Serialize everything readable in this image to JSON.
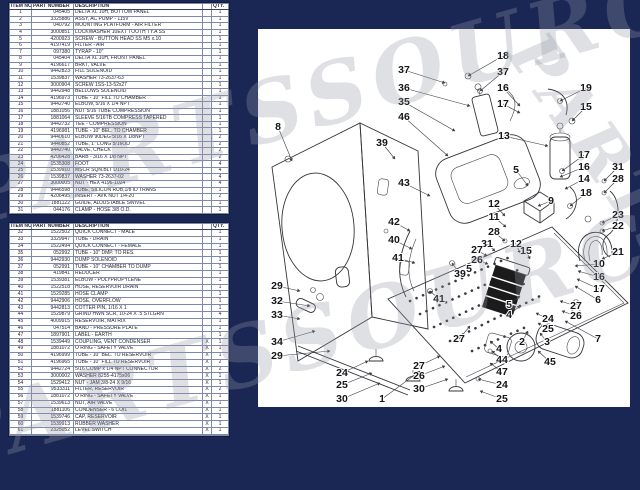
{
  "page": {
    "background_color": "#1a2755",
    "paper_color": "#ffffff"
  },
  "watermark": {
    "text": "PARTSSOURCE",
    "fragments": [
      {
        "text": "PARTSSOURCE",
        "x": -45,
        "y": 150,
        "rot": -16,
        "size": 84,
        "spacing": 8
      },
      {
        "text": "PARTSSOURCE",
        "x": -70,
        "y": 395,
        "rot": -16,
        "size": 84,
        "spacing": 8
      },
      {
        "text": "PARTSSO",
        "x": 556,
        "y": 18,
        "rot": 55,
        "size": 66,
        "spacing": 6
      }
    ]
  },
  "tables": {
    "headers": [
      "ITEM NO.",
      "PART NUMBER",
      "DESCRIPTION",
      "",
      "QTY."
    ],
    "table1": {
      "rows": [
        [
          "1",
          "045405",
          "DELTA XL 10H, BOTTOM PANEL",
          "",
          "1"
        ],
        [
          "2",
          "3325886",
          "ASSY, AC PUMP - 115V",
          "",
          "1"
        ],
        [
          "3",
          "040792",
          "MOUNTING PLATFORM - AIR FILTER",
          "",
          "1"
        ],
        [
          "4",
          "3000851",
          "LOCKWASHER 10EXT TOOTH TY.A SS",
          "",
          "1"
        ],
        [
          "5",
          "4200923",
          "SCREW - BUTTON HEAD SS M5 x.10",
          "",
          "1"
        ],
        [
          "6",
          "4197419",
          "FILTER - AIR",
          "",
          "1"
        ],
        [
          "7",
          "097380",
          "TYRAP - 10\"",
          "",
          "1"
        ],
        [
          "8",
          "045404",
          "DELTA XL 10H, FRONT PANEL",
          "",
          "1"
        ],
        [
          "9",
          "4196617",
          "BRKT, VALVE",
          "",
          "1"
        ],
        [
          "10",
          "9442823",
          "FILL SOLENOID",
          "",
          "1"
        ],
        [
          "11",
          "1539837",
          "WASHER 73-2637-63",
          "",
          "1"
        ],
        [
          "12",
          "3000904",
          "SCREW 1SS-13-52x27",
          "",
          "1"
        ],
        [
          "13",
          "9442948",
          "BELLOWS SOLENOID",
          "",
          "1"
        ],
        [
          "14",
          "4196973",
          "TUBE - 10\" FILL TO CHAMBER",
          "",
          "1"
        ],
        [
          "15",
          "9442740",
          "ELBOW, 5/16 X 1/4 NPT",
          "",
          "1"
        ],
        [
          "16",
          "1881056",
          "NUT 5/16 TUBE COMPRESSION",
          "",
          "1"
        ],
        [
          "17",
          "1881064",
          "SLEEVE 5/16TB COMPRESS TAPERED",
          "",
          "1"
        ],
        [
          "18",
          "9442732",
          "TEE - COMPRESSION",
          "",
          "1"
        ],
        [
          "19",
          "4196981",
          "TUBE - 10\" BEL. TO CHAMBER",
          "",
          "1"
        ],
        [
          "20",
          "9440610",
          "ELBOW 90DEG 5/16 X 1/8NPT",
          "",
          "2"
        ],
        [
          "21",
          "9440852",
          "TUBE, 1\" LONG 5/16OD",
          "",
          "2"
        ],
        [
          "22",
          "9442740",
          "VALVE, CHECK",
          "",
          "2"
        ],
        [
          "23",
          "4206428",
          "BARB - 3/16 X 1/8 NPT",
          "",
          "2"
        ],
        [
          "24",
          "1535308",
          "FOOT",
          "",
          "4"
        ],
        [
          "25",
          "1539910",
          "MSCR SQN.BLT D10-24",
          "",
          "4"
        ],
        [
          "26",
          "1539837",
          "WASHER 73-2637-02",
          "",
          "4"
        ],
        [
          "27",
          "3000005",
          "NUT - HEX 4196-1024",
          "",
          "4"
        ],
        [
          "28",
          "9446598",
          "TUBE, SILICON RUB,1/8 ID TRANS",
          "",
          "1"
        ],
        [
          "29",
          "4206495",
          "INSERT - AVK NUT 1/4-20",
          "",
          "2"
        ],
        [
          "30",
          "1881122",
          "GUIDE, ADJUSTABLE SWIVEL",
          "",
          "1"
        ],
        [
          "31",
          "044176",
          "CLAMP - HOSE 3/8 O.D.",
          "",
          "1"
        ]
      ]
    },
    "table2": {
      "rows": [
        [
          "32",
          "1522502",
          "QUICK CONNECT - MALE",
          "",
          "1"
        ],
        [
          "33",
          "3329947",
          "TUBE - DRAIN",
          "",
          "1"
        ],
        [
          "34",
          "1522494",
          "QUICK CONNECT - FEMALE",
          "",
          "1"
        ],
        [
          "35",
          "052992",
          "TUBE - 10\" DMP. TO RES.",
          "",
          "1"
        ],
        [
          "36",
          "9442930",
          "DUMP SOLENOID",
          "",
          "1"
        ],
        [
          "37",
          "052991",
          "TUBE - 10\" CHAMBER TO DUMP",
          "",
          "1"
        ],
        [
          "38",
          "419841",
          "REDUCER",
          "",
          "1"
        ],
        [
          "39",
          "1539381",
          "ELBOW - POLYPROPYLENE",
          "",
          "1"
        ],
        [
          "40",
          "1522518",
          "HOSE, RESERVOIR DRAIN",
          "",
          "1"
        ],
        [
          "41",
          "1529285",
          "HOSE CLAMP",
          "",
          "1"
        ],
        [
          "42",
          "9442906",
          "HOSE, OVERFLOW",
          "",
          "1"
        ],
        [
          "43",
          "9442813",
          "COTTER PIN, 1/16 X 1",
          "",
          "1"
        ],
        [
          "44",
          "1529879",
          "GRIND HWN SCR, 10-24 X .5 STLGRN",
          "",
          "4"
        ],
        [
          "45",
          "4009915",
          "RESERVOIR, MATRIX",
          "",
          "1"
        ],
        [
          "46",
          "047514",
          "BAND - PRESSURE PLATE",
          "",
          "1"
        ],
        [
          "47",
          "1897901",
          "LABEL - EARTH",
          "",
          "1"
        ],
        [
          "48",
          "1539449",
          "COUPLING, VENT CONDENSER",
          "X",
          "1"
        ],
        [
          "49",
          "1881072",
          "O RING - SAFETY VALVE",
          "X",
          "1"
        ],
        [
          "50",
          "4196999",
          "TUBE - 10\" BEL. TO RESERVOIR",
          "X",
          "1"
        ],
        [
          "51",
          "4196965",
          "TUBE - 10\" FILL TO RESERVOIR",
          "X",
          "2"
        ],
        [
          "52",
          "9442724",
          "5/16 COMP x 1/4 NPT CONNECTOR",
          "X",
          "2"
        ],
        [
          "53",
          "3000002",
          "WASHER 8255-4175x06",
          "X",
          "1"
        ],
        [
          "54",
          "1529412",
          "NUT - JAM 3/8-24 X 9/16",
          "X",
          "1"
        ],
        [
          "55",
          "9533311",
          "FILTER, RESERVOIR",
          "X",
          "2"
        ],
        [
          "56",
          "1881072",
          "O RING - SAFETY VALVE",
          "X",
          "1"
        ],
        [
          "57",
          "1539613",
          "NUT, AIR VALVE",
          "X",
          "1"
        ],
        [
          "58",
          "1881106",
          "CONDENSER - 6 COIL",
          "X",
          "1"
        ],
        [
          "59",
          "1539746",
          "CAP, RESERVOIR",
          "X",
          "1"
        ],
        [
          "60",
          "1539913",
          "RUBBER WASHER",
          "X",
          "1"
        ],
        [
          "61",
          "2325052",
          "LEVEL SWITCH",
          "X",
          "1"
        ],
        [
          "",
          "",
          "",
          "",
          ""
        ]
      ]
    }
  },
  "diagram": {
    "callouts": [
      [
        "18",
        245,
        27,
        210,
        47
      ],
      [
        "37",
        146,
        41,
        187,
        54
      ],
      [
        "37",
        245,
        43,
        222,
        62
      ],
      [
        "36",
        146,
        59,
        212,
        77
      ],
      [
        "16",
        245,
        59,
        262,
        77
      ],
      [
        "35",
        146,
        73,
        197,
        102
      ],
      [
        "17",
        245,
        75,
        262,
        84
      ],
      [
        "19",
        328,
        59,
        302,
        72
      ],
      [
        "15",
        328,
        78,
        314,
        92
      ],
      [
        "46",
        146,
        88,
        190,
        127
      ],
      [
        "13",
        246,
        107,
        290,
        117
      ],
      [
        "8",
        20,
        98,
        34,
        132
      ],
      [
        "39",
        124,
        114,
        137,
        130
      ],
      [
        "5",
        258,
        141,
        270,
        157
      ],
      [
        "43",
        146,
        154,
        172,
        167
      ],
      [
        "17",
        326,
        126,
        304,
        142
      ],
      [
        "16",
        326,
        138,
        302,
        148
      ],
      [
        "31",
        360,
        138,
        346,
        152
      ],
      [
        "14",
        326,
        150,
        307,
        160
      ],
      [
        "28",
        360,
        150,
        346,
        164
      ],
      [
        "18",
        328,
        164,
        312,
        177
      ],
      [
        "12",
        236,
        175,
        247,
        187
      ],
      [
        "9",
        293,
        172,
        280,
        177
      ],
      [
        "11",
        236,
        188,
        248,
        198
      ],
      [
        "23",
        360,
        186,
        344,
        194
      ],
      [
        "22",
        360,
        197,
        344,
        202
      ],
      [
        "28",
        236,
        203,
        247,
        212
      ],
      [
        "12",
        258,
        215,
        262,
        224
      ],
      [
        "15",
        268,
        222,
        272,
        230
      ],
      [
        "21",
        360,
        223,
        344,
        230
      ],
      [
        "10",
        341,
        235,
        317,
        237
      ],
      [
        "42",
        136,
        193,
        152,
        202
      ],
      [
        "40",
        136,
        211,
        154,
        220
      ],
      [
        "41",
        140,
        229,
        157,
        234
      ],
      [
        "29",
        19,
        257,
        42,
        262
      ],
      [
        "32",
        19,
        272,
        52,
        277
      ],
      [
        "33",
        19,
        286,
        42,
        290
      ],
      [
        "34",
        19,
        313,
        57,
        302
      ],
      [
        "29",
        19,
        327,
        72,
        322
      ],
      [
        "24",
        84,
        344,
        110,
        332
      ],
      [
        "25",
        84,
        356,
        114,
        344
      ],
      [
        "30",
        84,
        370,
        122,
        354
      ],
      [
        "1",
        124,
        370,
        162,
        342
      ],
      [
        "27",
        161,
        337,
        182,
        327
      ],
      [
        "26",
        161,
        347,
        187,
        337
      ],
      [
        "30",
        161,
        360,
        190,
        350
      ],
      [
        "39",
        202,
        245,
        194,
        234
      ],
      [
        "5",
        211,
        240,
        216,
        230
      ],
      [
        "41",
        181,
        270,
        172,
        262
      ],
      [
        "27",
        201,
        310,
        212,
        297
      ],
      [
        "31",
        229,
        215,
        237,
        222
      ],
      [
        "27",
        219,
        221,
        229,
        227
      ],
      [
        "26",
        219,
        231,
        230,
        235
      ],
      [
        "5",
        251,
        276,
        262,
        267
      ],
      [
        "4",
        251,
        286,
        262,
        277
      ],
      [
        "2",
        264,
        313,
        270,
        302
      ],
      [
        "3",
        289,
        313,
        282,
        304
      ],
      [
        "24",
        290,
        290,
        278,
        284
      ],
      [
        "25",
        290,
        300,
        280,
        294
      ],
      [
        "44",
        244,
        331,
        234,
        322
      ],
      [
        "47",
        244,
        343,
        232,
        334
      ],
      [
        "4",
        241,
        320,
        232,
        312
      ],
      [
        "24",
        244,
        356,
        220,
        350
      ],
      [
        "25",
        244,
        370,
        222,
        362
      ],
      [
        "45",
        292,
        333,
        280,
        322
      ],
      [
        "7",
        340,
        310,
        307,
        292
      ],
      [
        "27",
        318,
        277,
        302,
        272
      ],
      [
        "26",
        318,
        287,
        304,
        282
      ],
      [
        "6",
        340,
        271,
        317,
        257
      ],
      [
        "17",
        341,
        260,
        319,
        250
      ],
      [
        "16",
        341,
        248,
        320,
        242
      ]
    ]
  }
}
